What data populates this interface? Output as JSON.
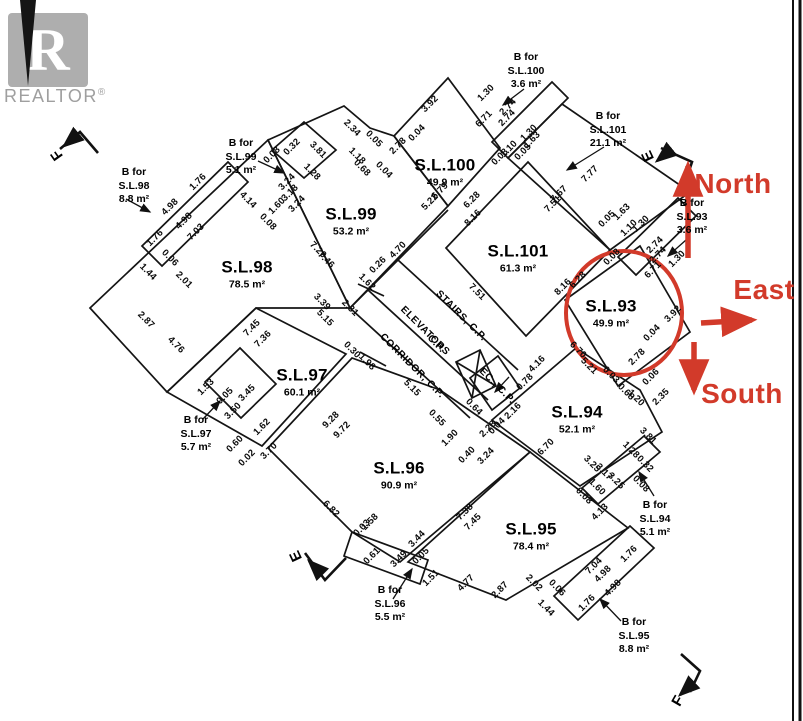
{
  "colors": {
    "red": "#d23a2a",
    "line": "#111111",
    "logo_gray": "#aeaeae",
    "logo_text_gray": "#9f9f9f"
  },
  "logo": {
    "letter": "R",
    "text": "REALTOR",
    "reg": "®"
  },
  "highlighted_unit": "S.L.93",
  "compass": [
    {
      "label": "North",
      "x": 733,
      "y": 184
    },
    {
      "label": "East",
      "x": 764,
      "y": 290
    },
    {
      "label": "South",
      "x": 742,
      "y": 394
    }
  ],
  "units": [
    {
      "name": "S.L.98",
      "area": "78.5 m²",
      "x": 247,
      "y": 274
    },
    {
      "name": "S.L.99",
      "area": "53.2 m²",
      "x": 351,
      "y": 221
    },
    {
      "name": "S.L.100",
      "area": "49.9 m²",
      "x": 445,
      "y": 172
    },
    {
      "name": "S.L.101",
      "area": "61.3 m²",
      "x": 518,
      "y": 258
    },
    {
      "name": "S.L.93",
      "area": "49.9 m²",
      "x": 611,
      "y": 313
    },
    {
      "name": "S.L.97",
      "area": "60.1 m²",
      "x": 302,
      "y": 382
    },
    {
      "name": "S.L.94",
      "area": "52.1 m²",
      "x": 577,
      "y": 419
    },
    {
      "name": "S.L.96",
      "area": "90.9 m²",
      "x": 399,
      "y": 475
    },
    {
      "name": "S.L.95",
      "area": "78.4 m²",
      "x": 531,
      "y": 536
    }
  ],
  "balconies": [
    {
      "lines": [
        "B for",
        "S.L.98",
        "8.8 m²"
      ],
      "x": 134,
      "y": 186
    },
    {
      "lines": [
        "B for",
        "S.L.99",
        "5.1 m²"
      ],
      "x": 241,
      "y": 157
    },
    {
      "lines": [
        "B for",
        "S.L.100",
        "3.6 m²"
      ],
      "x": 526,
      "y": 71
    },
    {
      "lines": [
        "B for",
        "S.L.101",
        "21.1 m²"
      ],
      "x": 608,
      "y": 130
    },
    {
      "lines": [
        "B for",
        "S.L.93",
        "3.6 m²"
      ],
      "x": 692,
      "y": 217
    },
    {
      "lines": [
        "B for",
        "S.L.97",
        "5.7 m²"
      ],
      "x": 196,
      "y": 434
    },
    {
      "lines": [
        "B for",
        "S.L.96",
        "5.5 m²"
      ],
      "x": 390,
      "y": 604
    },
    {
      "lines": [
        "B for",
        "S.L.94",
        "5.1 m²"
      ],
      "x": 655,
      "y": 519
    },
    {
      "lines": [
        "B for",
        "S.L.95",
        "8.8 m²"
      ],
      "x": 634,
      "y": 636
    }
  ],
  "core_labels": [
    {
      "text": "STAIRS, C.P.",
      "x": 461,
      "y": 316,
      "rot": 45
    },
    {
      "text": "ELEVATORS",
      "x": 425,
      "y": 331,
      "rot": 45
    },
    {
      "text": "C.P.",
      "x": 436,
      "y": 344,
      "rot": 45
    },
    {
      "text": "CORRIDOR, C.P.",
      "x": 412,
      "y": 366,
      "rot": 45
    },
    {
      "text": "EC., C.P.",
      "x": 497,
      "y": 386,
      "rot": 45
    }
  ],
  "corner_markers": [
    {
      "letter": "F",
      "x": 57,
      "y": 155,
      "rot": -125
    },
    {
      "letter": "E",
      "x": 648,
      "y": 156,
      "rot": -115
    },
    {
      "letter": "E",
      "x": 296,
      "y": 556,
      "rot": -115
    },
    {
      "letter": "F",
      "x": 678,
      "y": 701,
      "rot": -60
    }
  ],
  "dims": [
    [
      "1.76",
      198,
      182,
      -45
    ],
    [
      "4.98",
      170,
      207,
      -45
    ],
    [
      "4.98",
      184,
      221,
      -45
    ],
    [
      "7.03",
      196,
      232,
      -45
    ],
    [
      "1.76",
      155,
      238,
      -45
    ],
    [
      "0.06",
      170,
      258,
      45
    ],
    [
      "1.44",
      148,
      272,
      45
    ],
    [
      "2.01",
      184,
      280,
      45
    ],
    [
      "2.87",
      146,
      320,
      45
    ],
    [
      "4.76",
      176,
      345,
      45
    ],
    [
      "4.14",
      248,
      200,
      45
    ],
    [
      "0.08",
      268,
      222,
      45
    ],
    [
      "0.08",
      272,
      155,
      -45
    ],
    [
      "0.32",
      292,
      147,
      -45
    ],
    [
      "3.24",
      287,
      182,
      -45
    ],
    [
      "3.18",
      290,
      193,
      -45
    ],
    [
      "3.24",
      297,
      204,
      -45
    ],
    [
      "1.60",
      277,
      206,
      -45
    ],
    [
      "3.81",
      318,
      150,
      45
    ],
    [
      "1.28",
      312,
      172,
      45
    ],
    [
      "2.34",
      352,
      128,
      45
    ],
    [
      "0.05",
      374,
      139,
      45
    ],
    [
      "1.18",
      357,
      156,
      45
    ],
    [
      "0.68",
      362,
      168,
      45
    ],
    [
      "0.04",
      384,
      170,
      45
    ],
    [
      "3.92",
      430,
      104,
      -45
    ],
    [
      "0.04",
      417,
      133,
      -45
    ],
    [
      "2.78",
      398,
      146,
      -45
    ],
    [
      "6.79",
      440,
      191,
      -45
    ],
    [
      "5.22",
      430,
      202,
      -45
    ],
    [
      "1.30",
      486,
      93,
      -45
    ],
    [
      "2.74",
      508,
      107,
      -45
    ],
    [
      "2.74",
      507,
      118,
      -45
    ],
    [
      "6.71",
      484,
      119,
      -45
    ],
    [
      "1.30",
      529,
      133,
      -45
    ],
    [
      "0.08",
      500,
      157,
      -45
    ],
    [
      "1.10",
      509,
      149,
      -45
    ],
    [
      "1.63",
      532,
      140,
      -45
    ],
    [
      "0.05",
      523,
      152,
      -45
    ],
    [
      "6.28",
      472,
      200,
      -45
    ],
    [
      "8.16",
      473,
      218,
      -45
    ],
    [
      "7.67",
      559,
      194,
      -45
    ],
    [
      "7.51",
      553,
      204,
      -45
    ],
    [
      "7.77",
      590,
      174,
      -45
    ],
    [
      "4.70",
      398,
      250,
      -45
    ],
    [
      "0.26",
      378,
      265,
      -45
    ],
    [
      "1.62",
      367,
      282,
      45
    ],
    [
      "2.31",
      350,
      308,
      45
    ],
    [
      "7.51",
      477,
      292,
      45
    ],
    [
      "8.16",
      563,
      287,
      -45
    ],
    [
      "6.28",
      578,
      280,
      -45
    ],
    [
      "0.05",
      607,
      219,
      -45
    ],
    [
      "1.63",
      622,
      212,
      -45
    ],
    [
      "1.10",
      629,
      228,
      -45
    ],
    [
      "1.30",
      641,
      224,
      -45
    ],
    [
      "0.08",
      612,
      257,
      -45
    ],
    [
      "2.74",
      655,
      245,
      -45
    ],
    [
      "2.74",
      658,
      255,
      -45
    ],
    [
      "1.30",
      677,
      259,
      -45
    ],
    [
      "6.71",
      653,
      270,
      -45
    ],
    [
      "3.92",
      673,
      314,
      -45
    ],
    [
      "0.04",
      652,
      333,
      -45
    ],
    [
      "2.78",
      637,
      357,
      -45
    ],
    [
      "6.70",
      578,
      350,
      45
    ],
    [
      "5.21",
      589,
      366,
      45
    ],
    [
      "0.03",
      611,
      375,
      45
    ],
    [
      "0.68",
      626,
      392,
      45
    ],
    [
      "1.20",
      636,
      398,
      45
    ],
    [
      "0.06",
      651,
      377,
      -45
    ],
    [
      "2.35",
      661,
      397,
      -45
    ],
    [
      "3.81",
      648,
      436,
      45
    ],
    [
      "1.28",
      631,
      450,
      45
    ],
    [
      "0.32",
      645,
      464,
      45
    ],
    [
      "0.08",
      641,
      484,
      45
    ],
    [
      "3.25",
      592,
      464,
      45
    ],
    [
      "3.17",
      604,
      472,
      45
    ],
    [
      "3.25",
      616,
      481,
      45
    ],
    [
      "1.60",
      597,
      487,
      45
    ],
    [
      "0.08",
      584,
      496,
      45
    ],
    [
      "4.13",
      600,
      512,
      -45
    ],
    [
      "6.70",
      546,
      447,
      -45
    ],
    [
      "4.16",
      537,
      364,
      -45
    ],
    [
      "0.78",
      525,
      382,
      -45
    ],
    [
      "2.16",
      513,
      411,
      -45
    ],
    [
      "0.04",
      497,
      426,
      -45
    ],
    [
      "2.28",
      488,
      429,
      -45
    ],
    [
      "3.24",
      486,
      456,
      -45
    ],
    [
      "0.40",
      467,
      455,
      -45
    ],
    [
      "1.90",
      450,
      438,
      -45
    ],
    [
      "0.55",
      437,
      418,
      45
    ],
    [
      "0.64",
      474,
      407,
      45
    ],
    [
      "0.30",
      352,
      350,
      45
    ],
    [
      "1.98",
      367,
      362,
      45
    ],
    [
      "3.39",
      322,
      302,
      45
    ],
    [
      "5.15",
      325,
      318,
      45
    ],
    [
      "5.15",
      412,
      388,
      45
    ],
    [
      "7.20",
      318,
      250,
      45
    ],
    [
      "7.46",
      326,
      260,
      45
    ],
    [
      "7.45",
      252,
      328,
      -45
    ],
    [
      "7.36",
      263,
      339,
      -45
    ],
    [
      "1.53",
      206,
      387,
      -45
    ],
    [
      "0.05",
      225,
      396,
      -45
    ],
    [
      "3.45",
      247,
      393,
      -45
    ],
    [
      "3.50",
      233,
      411,
      -45
    ],
    [
      "1.62",
      262,
      427,
      -45
    ],
    [
      "0.60",
      235,
      444,
      -45
    ],
    [
      "0.02",
      247,
      458,
      -45
    ],
    [
      "3.70",
      269,
      451,
      -45
    ],
    [
      "9.28",
      331,
      420,
      -45
    ],
    [
      "9.72",
      342,
      430,
      -45
    ],
    [
      "6.82",
      331,
      509,
      45
    ],
    [
      "0.03",
      362,
      528,
      -45
    ],
    [
      "1.58",
      370,
      522,
      -45
    ],
    [
      "0.61",
      372,
      556,
      -45
    ],
    [
      "3.49",
      399,
      559,
      -45
    ],
    [
      "3.44",
      417,
      539,
      -45
    ],
    [
      "0.05",
      421,
      556,
      -45
    ],
    [
      "1.51",
      431,
      578,
      -45
    ],
    [
      "4.77",
      466,
      583,
      -45
    ],
    [
      "2.87",
      500,
      590,
      -45
    ],
    [
      "2.02",
      534,
      583,
      45
    ],
    [
      "0.06",
      557,
      588,
      45
    ],
    [
      "1.44",
      546,
      608,
      45
    ],
    [
      "7.38",
      465,
      512,
      -45
    ],
    [
      "7.45",
      473,
      522,
      -45
    ],
    [
      "7.04",
      594,
      566,
      -45
    ],
    [
      "4.98",
      603,
      574,
      -45
    ],
    [
      "4.98",
      613,
      588,
      -45
    ],
    [
      "1.76",
      629,
      554,
      -45
    ],
    [
      "1.76",
      587,
      603,
      -45
    ]
  ]
}
